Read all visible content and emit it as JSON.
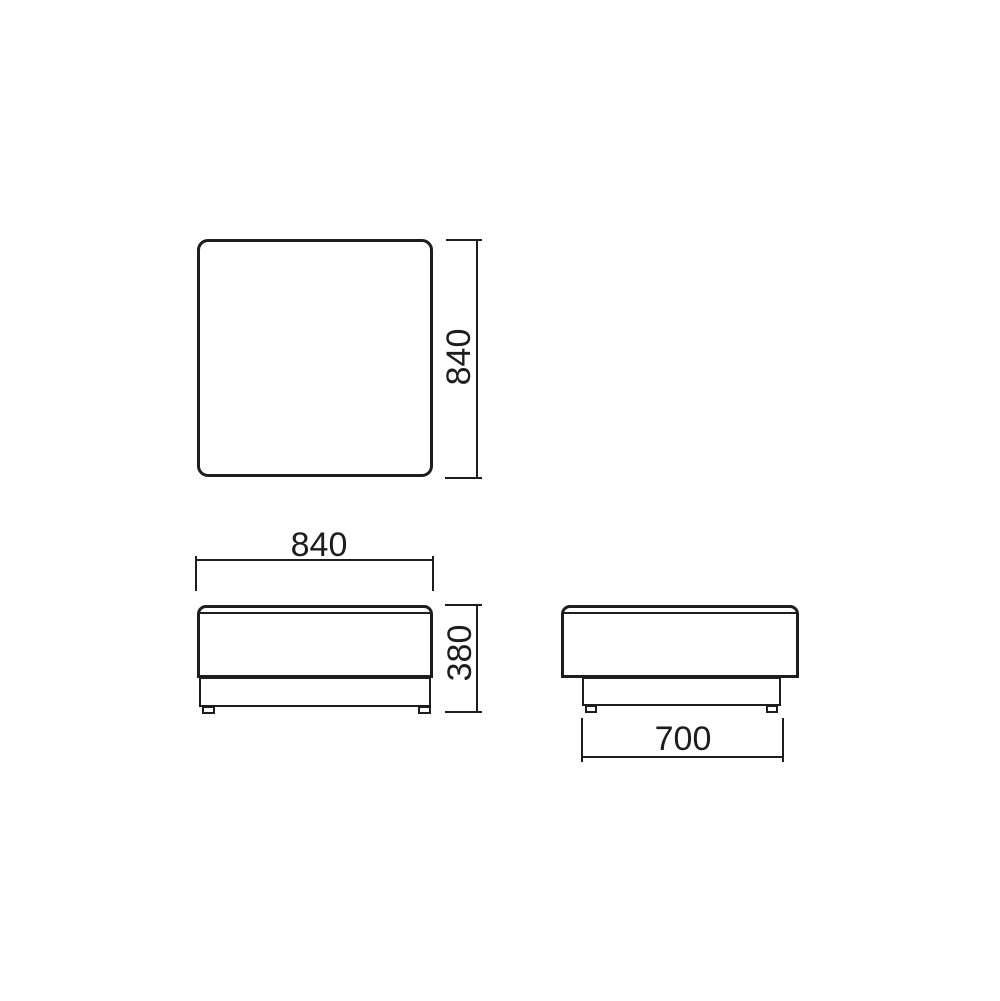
{
  "canvas": {
    "background_color": "#ffffff",
    "line_color": "#1d1d1b"
  },
  "drawing": {
    "dimensions": {
      "plan_depth": "840",
      "front_width": "840",
      "front_height": "380",
      "side_depth": "700"
    }
  }
}
